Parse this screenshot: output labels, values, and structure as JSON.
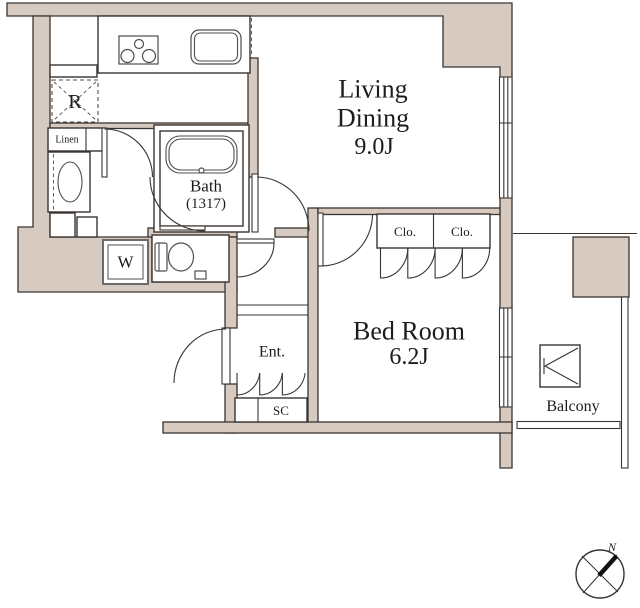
{
  "floor_plan": {
    "living_dining": {
      "line1": "Living",
      "line2": "Dining",
      "size": "9.0J"
    },
    "bed_room": {
      "name": "Bed Room",
      "size": "6.2J"
    },
    "bath": {
      "name": "Bath",
      "size": "(1317)"
    },
    "refrigerator": {
      "label": "R"
    },
    "linen": {
      "label": "Linen"
    },
    "washer": {
      "label": "W"
    },
    "closet_left": {
      "label": "Clo."
    },
    "closet_right": {
      "label": "Clo."
    },
    "entrance": {
      "label": "Ent."
    },
    "shoe_closet": {
      "label": "SC"
    },
    "balcony": {
      "label": "Balcony"
    },
    "compass": {
      "north": "N"
    },
    "colors": {
      "wall_fill": "#d7cac1",
      "wall_line": "#3a3430",
      "fixture_line": "#4d4d4d",
      "text": "#1c1c1c",
      "background": "#ffffff"
    }
  }
}
